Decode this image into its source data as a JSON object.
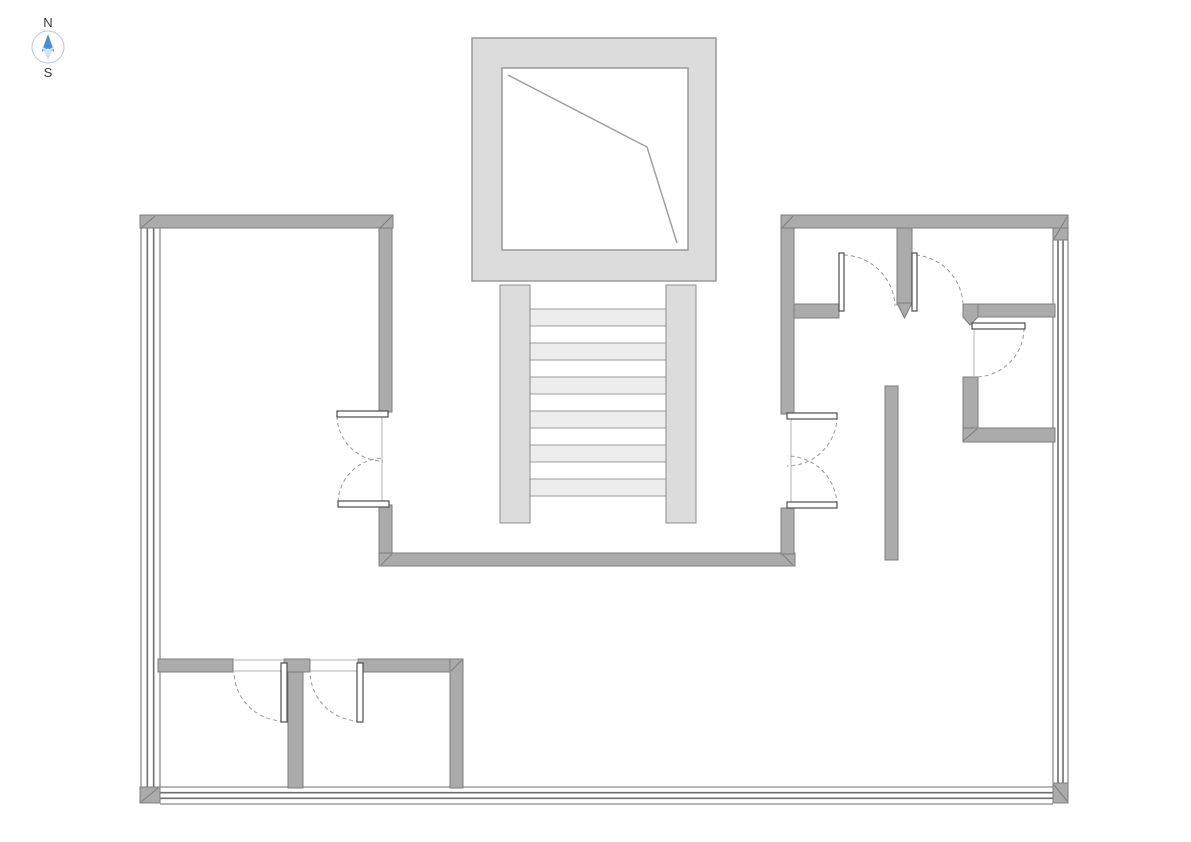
{
  "compass": {
    "north_label": "N",
    "south_label": "S",
    "ring_color": "#b5c9da",
    "needle_north_color": "#4a90d2",
    "needle_south_color": "#d9e1e8",
    "label_color": "#3a3a3a"
  },
  "floorplan": {
    "background": "#ffffff",
    "wall_fill": "#ababab",
    "wall_stroke": "#7d7d7d",
    "glass_stroke": "#6e6e6e",
    "door_leaf_fill": "#ffffff",
    "door_leaf_stroke": "#4d4d4d",
    "door_arc_color": "#9a9a9a",
    "open_line_color": "#b3b3b3",
    "shaft_fill": "#dcdcdc",
    "shaft_stroke": "#9a9a9a",
    "shaft_line_color": "#a0a0a0",
    "stair_rail_fill": "#dcdcdc",
    "stair_rail_stroke": "#8c8c8c",
    "stair_tread_fill_a": "#ededed",
    "stair_tread_fill_b": "#ffffff",
    "stair_tread_stroke": "#9a9a9a",
    "walls": [
      [
        140,
        215,
        253,
        13
      ],
      [
        379,
        228,
        13,
        184
      ],
      [
        379,
        505,
        13,
        49
      ],
      [
        379,
        553,
        416,
        13
      ],
      [
        781,
        508,
        13,
        46
      ],
      [
        781,
        215,
        287,
        13
      ],
      [
        781,
        228,
        13,
        186
      ],
      [
        794,
        304,
        45,
        14
      ],
      [
        897,
        228,
        15,
        77
      ],
      [
        963,
        304,
        92,
        13
      ],
      [
        963,
        377,
        15,
        52
      ],
      [
        963,
        428,
        92,
        14
      ],
      [
        885,
        386,
        13,
        174
      ],
      [
        158,
        659,
        75,
        13
      ],
      [
        284,
        659,
        26,
        13
      ],
      [
        358,
        659,
        105,
        13
      ],
      [
        288,
        672,
        15,
        116
      ],
      [
        450,
        659,
        13,
        129
      ]
    ],
    "pointed_walls": [
      [
        [
          897,
          303
        ],
        [
          912,
          303
        ],
        [
          904.5,
          318
        ]
      ],
      [
        [
          963,
          304
        ],
        [
          978,
          304
        ],
        [
          978,
          317
        ],
        [
          970,
          325
        ],
        [
          963,
          317
        ]
      ]
    ],
    "corner_blocks": [
      {
        "x": 1053,
        "y": 228,
        "w": 15,
        "h": 12,
        "d": [
          1054,
          239,
          1067,
          217
        ]
      },
      {
        "x": 140,
        "y": 787,
        "w": 20,
        "h": 16,
        "d": [
          141,
          802,
          158,
          788
        ]
      },
      {
        "x": 1053,
        "y": 783,
        "w": 15,
        "h": 20,
        "d": [
          1054,
          785,
          1067,
          801
        ]
      }
    ],
    "miters": [
      [
        141,
        228,
        155,
        216
      ],
      [
        380,
        228,
        392,
        216
      ],
      [
        782,
        228,
        793,
        216
      ],
      [
        381,
        565,
        392,
        554
      ],
      [
        782,
        554,
        793,
        565
      ],
      [
        963,
        441,
        977,
        429
      ],
      [
        451,
        671,
        462,
        660
      ]
    ],
    "window_walls": [
      {
        "o": "v",
        "x": 141,
        "y": 228,
        "t": 19,
        "len": 560
      },
      {
        "o": "v",
        "x": 1053,
        "y": 240,
        "t": 15,
        "len": 543
      },
      {
        "o": "h",
        "x": 160,
        "y": 787,
        "t": 17,
        "len": 893
      }
    ],
    "shaft": {
      "outer": [
        472,
        38,
        244,
        243
      ],
      "inner": [
        502,
        68,
        186,
        182
      ],
      "polyline": [
        [
          508,
          75
        ],
        [
          647,
          147
        ],
        [
          677,
          243
        ]
      ]
    },
    "stairs": {
      "rails": [
        [
          500,
          285,
          30,
          238
        ],
        [
          666,
          285,
          30,
          238
        ]
      ],
      "treads": {
        "x": 530,
        "w": 136,
        "y": 309,
        "count": 11,
        "h": 17
      }
    },
    "doors": [
      {
        "leaf": [
          337,
          411,
          51,
          6
        ],
        "arc": "M 337 416 A 46 46 0 0 0 383 461"
      },
      {
        "leaf": [
          338,
          501,
          51,
          6
        ],
        "arc": "M 338 502 A 46 46 0 0 1 383 458"
      },
      {
        "leaf": [
          787,
          413,
          50,
          6
        ],
        "arc": "M 837 416 A 50 50 0 0 1 787 466"
      },
      {
        "leaf": [
          787,
          502,
          50,
          6
        ],
        "arc": "M 837 505 A 50 50 0 0 0 787 456"
      },
      {
        "leaf": [
          839,
          253,
          5,
          58
        ],
        "arc": "M 844 255 A 53 53 0 0 1 895 306"
      },
      {
        "leaf": [
          912,
          253,
          5,
          58
        ],
        "arc": "M 916 255 A 52 52 0 0 1 963 303"
      },
      {
        "leaf": [
          972,
          323,
          53,
          6
        ],
        "arc": "M 1024 328 A 49 49 0 0 1 976 377"
      },
      {
        "leaf": [
          281,
          663,
          6,
          59
        ],
        "arc": "M 284 721 A 50 50 0 0 1 234 672"
      },
      {
        "leaf": [
          357,
          663,
          6,
          59
        ],
        "arc": "M 360 721 A 50 50 0 0 1 310 672"
      }
    ],
    "open_lines": [
      [
        382,
        417,
        382,
        501
      ],
      [
        791,
        419,
        791,
        502
      ],
      [
        974,
        330,
        974,
        376
      ],
      [
        233,
        660,
        284,
        660
      ],
      [
        310,
        660,
        358,
        660
      ],
      [
        233,
        671,
        284,
        671
      ],
      [
        310,
        671,
        358,
        671
      ]
    ]
  }
}
